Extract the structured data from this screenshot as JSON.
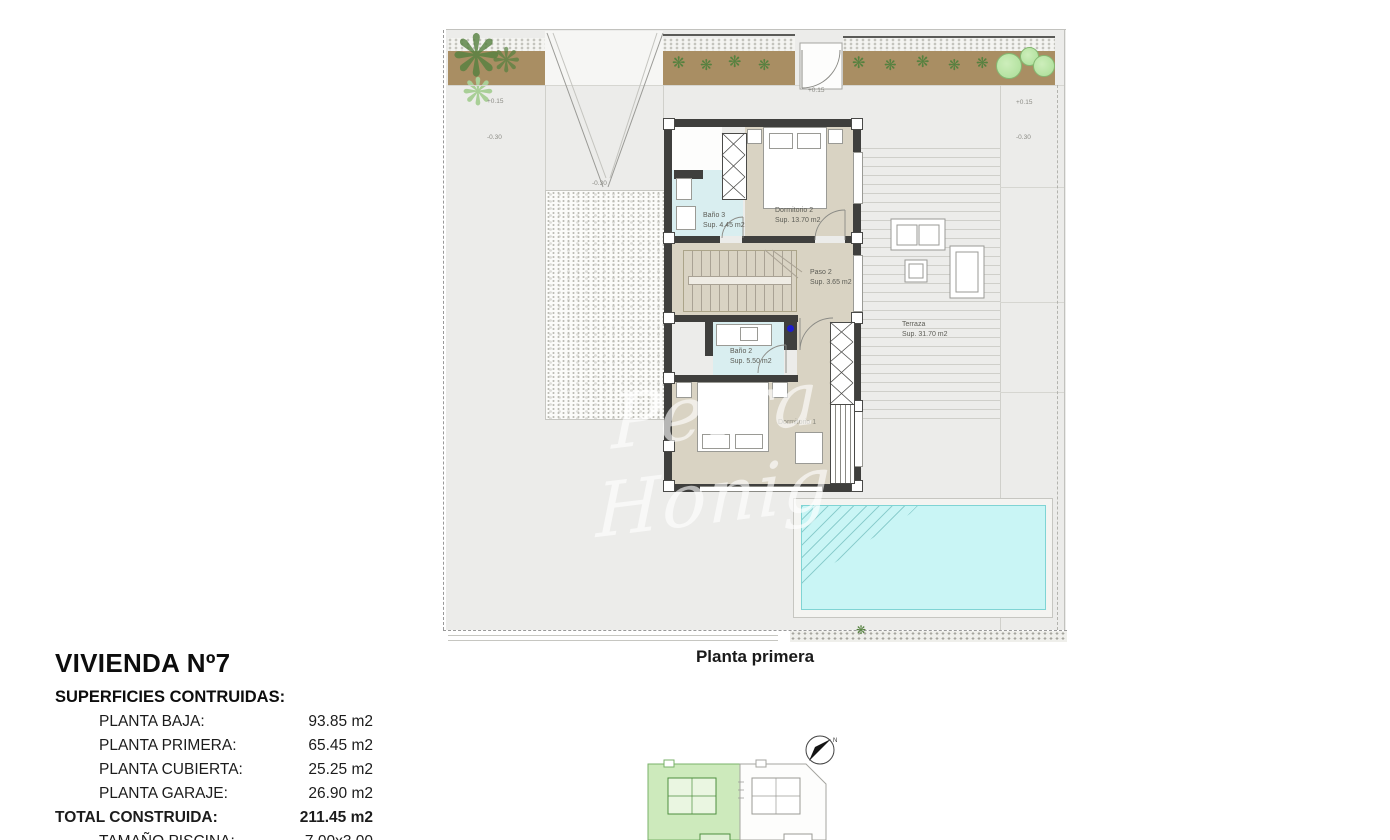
{
  "caption": "Planta primera",
  "watermark": "Petra Honig",
  "compass": {
    "label": "N"
  },
  "info": {
    "title": "VIVIENDA Nº7",
    "subtitle": "SUPERFICIES CONTRUIDAS:",
    "rows": [
      {
        "label": "PLANTA BAJA:",
        "value": "93.85 m2"
      },
      {
        "label": "PLANTA PRIMERA:",
        "value": "65.45 m2"
      },
      {
        "label": "PLANTA CUBIERTA:",
        "value": "25.25 m2"
      },
      {
        "label": "PLANTA GARAJE:",
        "value": "26.90 m2"
      }
    ],
    "total": {
      "label": "TOTAL CONSTRUIDA:",
      "value": "211.45 m2"
    },
    "extra": [
      {
        "label": "TAMAÑO PISCINA:",
        "value": "7.00x3.00"
      },
      {
        "label": "SOLARIUM:",
        "value": "37.00 m2"
      }
    ]
  },
  "rooms": {
    "bano3": {
      "name": "Baño 3",
      "area": "Sup. 4.45 m2"
    },
    "dormitorio2": {
      "name": "Dormitorio 2",
      "area": "Sup. 13.70 m2"
    },
    "paso2": {
      "name": "Paso 2",
      "area": "Sup. 3.65 m2"
    },
    "bano2": {
      "name": "Baño 2",
      "area": "Sup. 5.50 m2"
    },
    "dormitorio1": {
      "name": "Dormitorio 1",
      "area": ""
    },
    "terraza": {
      "name": "Terraza",
      "area": "Sup. 31.70 m2"
    }
  },
  "levels": [
    "+0.15",
    "-0.30",
    "-0.30",
    "+0.15",
    "+0.15",
    "-0.30"
  ],
  "colors": {
    "site": "#ececea",
    "wall": "#3f3f3d",
    "room_beige": "#d9d3c3",
    "bath_blue": "#d9eef0",
    "pool_water": "#c9f5f5",
    "planter_brown": "#a98e63",
    "keyplan_green": "#cdeabc"
  }
}
